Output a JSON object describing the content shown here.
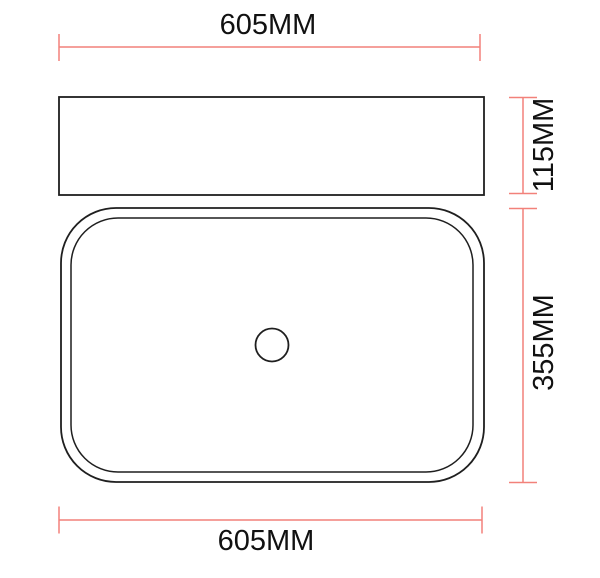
{
  "colors": {
    "dimension": "#f2817a",
    "outline": "#1f1f1f",
    "text": "#111111",
    "background": "#ffffff"
  },
  "dimensions": {
    "top_width": "605MM",
    "side_height": "115MM",
    "basin_depth": "355MM",
    "bottom_width": "605MM"
  }
}
